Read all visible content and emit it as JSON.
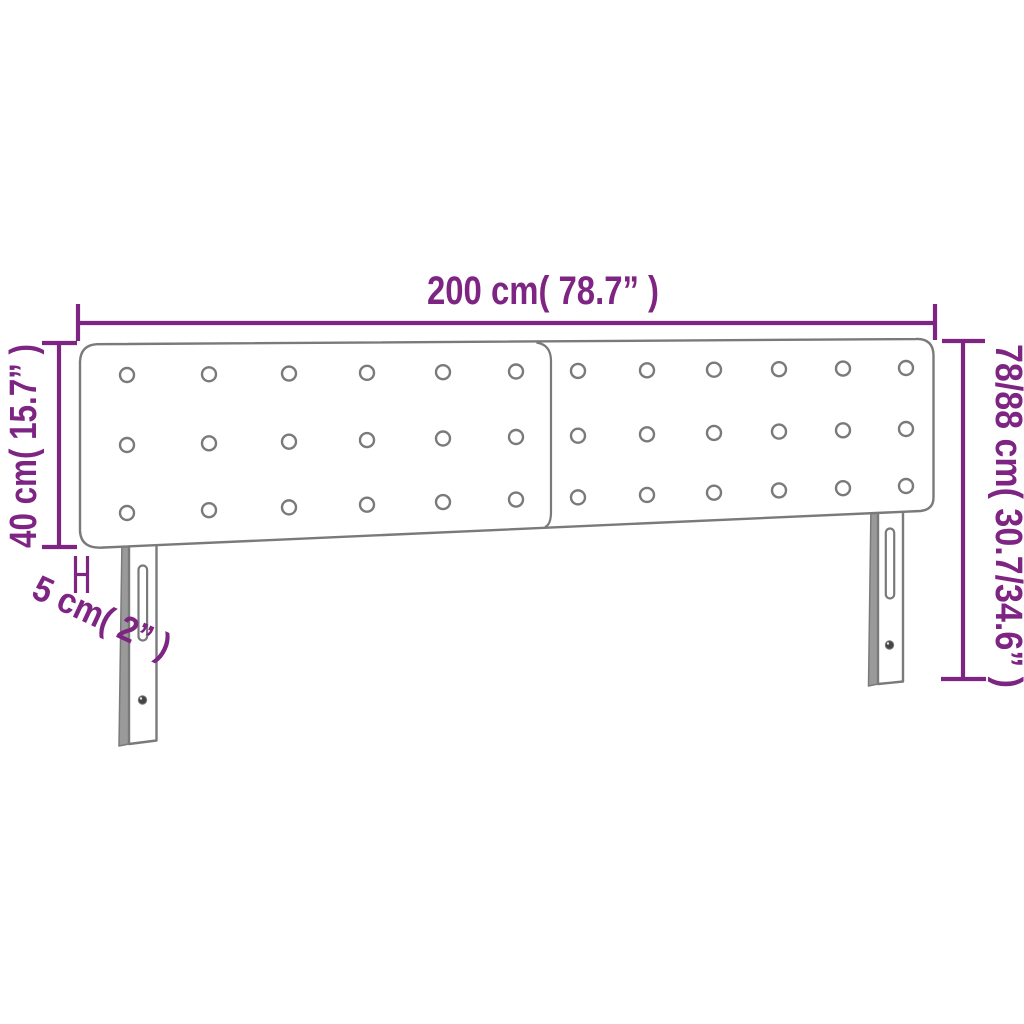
{
  "diagram": {
    "title": "Upholstered headboard dimension diagram",
    "labels": {
      "width": "200 cm( 78.7” )",
      "panel_height": "40 cm( 15.7” )",
      "total_height": "78/88 cm( 30.7/34.6” )",
      "thickness": "5 cm( 2” )"
    },
    "values": {
      "width_cm": "200",
      "width_inch": "78.7",
      "panel_height_cm": "40",
      "panel_height_inch": "15.7",
      "total_height_cm": "78/88",
      "total_height_inch": "30.7/34.6",
      "thickness_cm": "5",
      "thickness_inch": "2"
    },
    "colors": {
      "dimension_annotation": "#7e2483",
      "product_outline": "#7a7a7a",
      "background": "#ffffff"
    },
    "tufting": {
      "panels": 2,
      "button_rows": 3,
      "button_columns_per_panel": 6
    }
  }
}
